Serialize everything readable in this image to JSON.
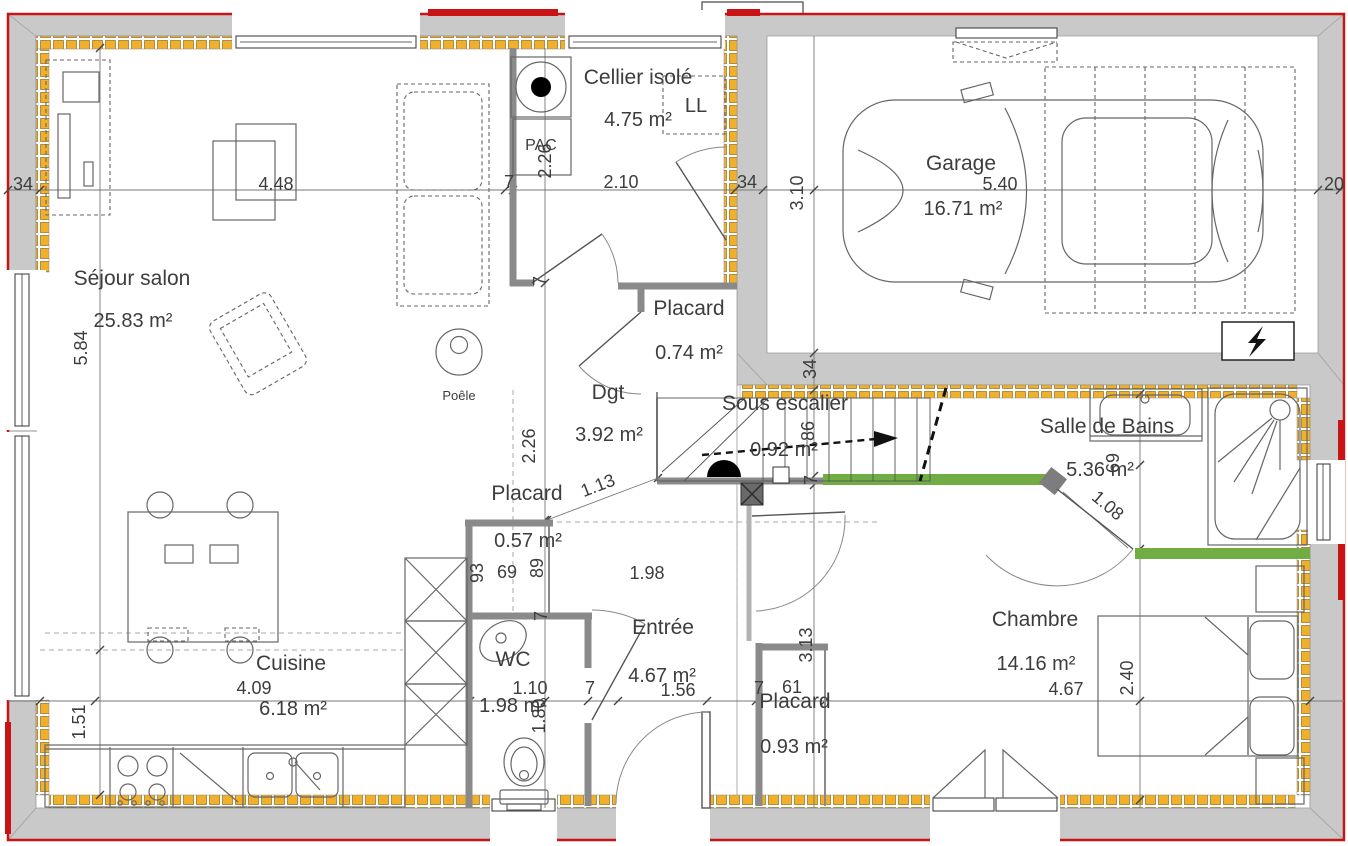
{
  "document": {
    "type": "floor-plan",
    "language": "fr",
    "colors": {
      "exterior_wall_gray": "#c9c9c9",
      "insulation_yellow": "#f0b02c",
      "outline_red": "#c81414",
      "partition_green": "#72ad44",
      "interior_wall_gray": "#8a8a8a",
      "text": "#3d3d3d"
    }
  },
  "rooms": [
    {
      "name": "Séjour salon",
      "area": "25.83 m²",
      "name_x": 132,
      "name_y": 285,
      "area_x": 133,
      "area_y": 327
    },
    {
      "name": "Cuisine",
      "area": "6.18 m²",
      "name_x": 291,
      "name_y": 670,
      "area_x": 293,
      "area_y": 715
    },
    {
      "name": "WC",
      "area": "1.98 m²",
      "name_x": 513,
      "name_y": 666,
      "area_x": 513,
      "area_y": 712
    },
    {
      "name": "Entrée",
      "area": "4.67 m²",
      "name_x": 663,
      "name_y": 634,
      "area_x": 662,
      "area_y": 682
    },
    {
      "name": "Placard",
      "area": "0.93 m²",
      "name_x": 795,
      "name_y": 708,
      "area_x": 794,
      "area_y": 753
    },
    {
      "name": "Chambre",
      "area": "14.16 m²",
      "name_x": 1035,
      "name_y": 626,
      "area_x": 1036,
      "area_y": 670
    },
    {
      "name": "Salle de Bains",
      "area": "5.36 m²",
      "name_x": 1107,
      "name_y": 433,
      "area_x": 1100,
      "area_y": 476
    },
    {
      "name": "Sous escalier",
      "area": "0.92 m²",
      "name_x": 785,
      "name_y": 410,
      "area_x": 784,
      "area_y": 456
    },
    {
      "name": "Dgt",
      "area": "3.92 m²",
      "name_x": 608,
      "name_y": 399,
      "area_x": 609,
      "area_y": 441
    },
    {
      "name": "Placard",
      "area": "0.74 m²",
      "name_x": 689,
      "name_y": 315,
      "area_x": 689,
      "area_y": 359
    },
    {
      "name": "Placard",
      "area": "0.57 m²",
      "name_x": 527,
      "name_y": 500,
      "area_x": 528,
      "area_y": 547
    },
    {
      "name": "Cellier isolé",
      "area": "4.75 m²",
      "name_x": 638,
      "name_y": 84,
      "area_x": 638,
      "area_y": 126
    },
    {
      "name": "Garage",
      "area": "16.71 m²",
      "name_x": 961,
      "name_y": 170,
      "area_x": 963,
      "area_y": 215
    }
  ],
  "equipment_labels": [
    {
      "text": "PAC",
      "x": 541,
      "y": 150,
      "size": 16
    },
    {
      "text": "LL",
      "x": 696,
      "y": 112,
      "size": 20
    },
    {
      "text": "Poêle",
      "x": 459,
      "y": 400,
      "size": 13
    }
  ],
  "dimensions": [
    {
      "text": "34",
      "x": 23,
      "y": 190
    },
    {
      "text": "4.48",
      "x": 276,
      "y": 190
    },
    {
      "text": "7",
      "x": 509,
      "y": 188
    },
    {
      "text": "2.26",
      "x": 551,
      "y": 161,
      "rot": -90
    },
    {
      "text": "2.10",
      "x": 621,
      "y": 188
    },
    {
      "text": "34",
      "x": 747,
      "y": 188
    },
    {
      "text": "3.10",
      "x": 803,
      "y": 193,
      "rot": -90
    },
    {
      "text": "5.40",
      "x": 1000,
      "y": 190
    },
    {
      "text": "20",
      "x": 1334,
      "y": 190
    },
    {
      "text": "5.84",
      "x": 87,
      "y": 348,
      "rot": -90
    },
    {
      "text": "7",
      "x": 546,
      "y": 281,
      "rot": -90
    },
    {
      "text": "34",
      "x": 816,
      "y": 369,
      "rot": -90
    },
    {
      "text": "86",
      "x": 814,
      "y": 431,
      "rot": -90
    },
    {
      "text": "7",
      "x": 817,
      "y": 480,
      "rot": -90
    },
    {
      "text": "2.26",
      "x": 535,
      "y": 446,
      "rot": -90
    },
    {
      "text": "1.13",
      "x": 600,
      "y": 491,
      "rot": -21
    },
    {
      "text": "93",
      "x": 483,
      "y": 573,
      "rot": -90
    },
    {
      "text": "69",
      "x": 507,
      "y": 578
    },
    {
      "text": "89",
      "x": 543,
      "y": 568,
      "rot": -90
    },
    {
      "text": "1.98",
      "x": 647,
      "y": 579
    },
    {
      "text": "69",
      "x": 1119,
      "y": 463,
      "rot": -90
    },
    {
      "text": "1.08",
      "x": 1104,
      "y": 510,
      "rot": 40
    },
    {
      "text": "1.51",
      "x": 85,
      "y": 722,
      "rot": -90
    },
    {
      "text": "4.09",
      "x": 254,
      "y": 694
    },
    {
      "text": "1.10",
      "x": 530,
      "y": 694
    },
    {
      "text": "1.80",
      "x": 545,
      "y": 716,
      "rot": -90
    },
    {
      "text": "7",
      "x": 590,
      "y": 694
    },
    {
      "text": "7",
      "x": 547,
      "y": 616,
      "rot": -90
    },
    {
      "text": "1.56",
      "x": 678,
      "y": 696
    },
    {
      "text": "7",
      "x": 759,
      "y": 694
    },
    {
      "text": "61",
      "x": 792,
      "y": 693
    },
    {
      "text": "3.13",
      "x": 812,
      "y": 645,
      "rot": -90
    },
    {
      "text": "4.67",
      "x": 1066,
      "y": 695
    },
    {
      "text": "2.40",
      "x": 1133,
      "y": 678,
      "rot": -90
    }
  ],
  "icons": [
    {
      "name": "electrical-panel-icon",
      "glyph": "lightning-bolt"
    }
  ]
}
